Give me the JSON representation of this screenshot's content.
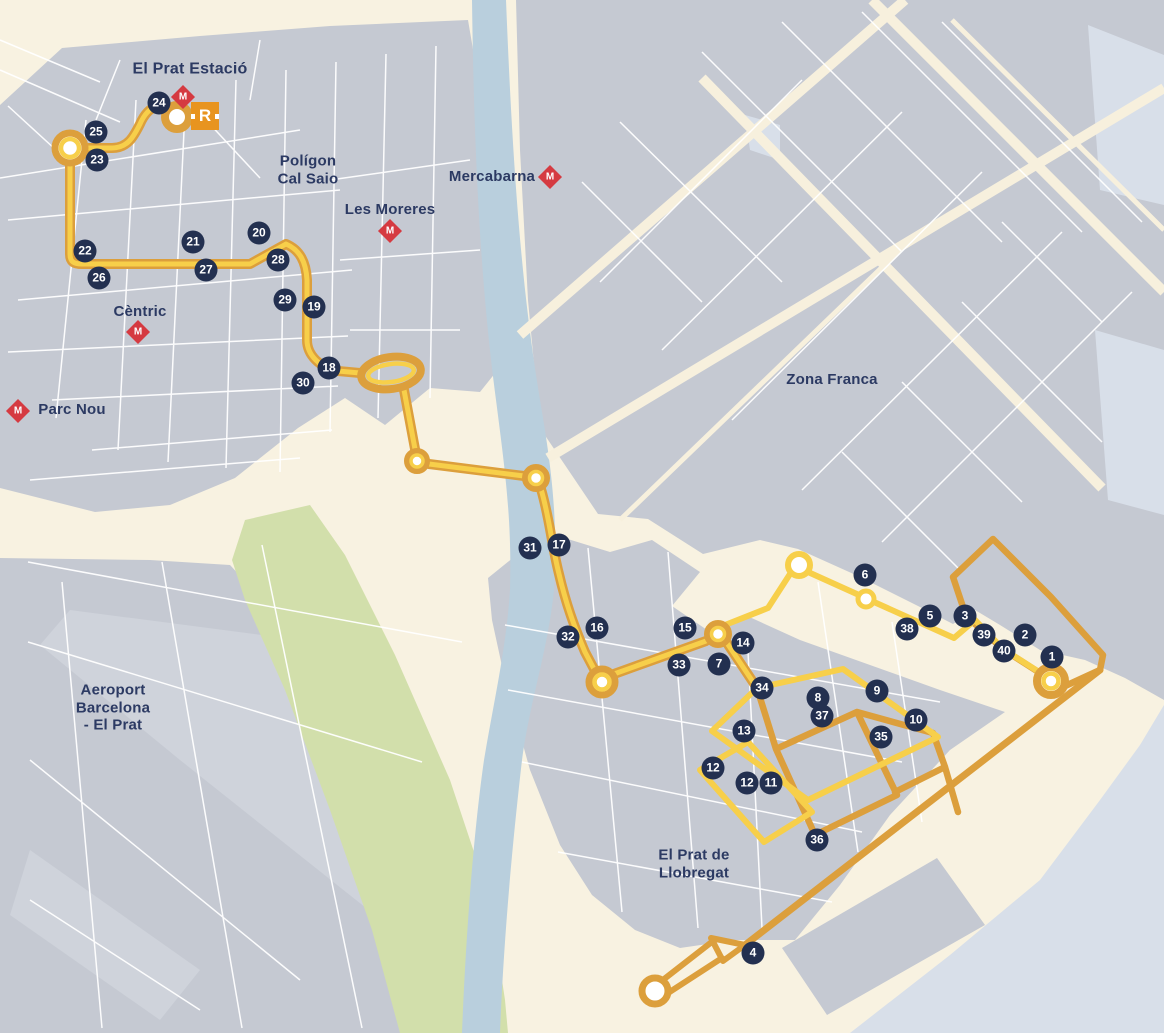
{
  "map": {
    "colors": {
      "background": "#f8f2e1",
      "urban": "#c5c9d2",
      "urban_light": "#cfd3db",
      "water_river": "#b9cfdd",
      "water_sea": "#d8dfe9",
      "park": "#d2dfab",
      "street": "#ffffff",
      "road_beige": "#f7f0dd",
      "route_yellow": "#f7cf4a",
      "route_orange": "#dc9f3c",
      "stop_badge_bg": "#233050",
      "stop_badge_text": "#ffffff",
      "label_text": "#2c3a63",
      "metro_red": "#d53a41",
      "rodalies_orange": "#e8941f"
    },
    "places": [
      {
        "id": "el-prat-estacio",
        "lines": [
          "El Prat Estació"
        ],
        "x": 190,
        "y": 70,
        "size": 16
      },
      {
        "id": "poligon-cal-saio",
        "lines": [
          "Polígon",
          "Cal Saio"
        ],
        "x": 308,
        "y": 170,
        "size": 15
      },
      {
        "id": "les-moreres",
        "lines": [
          "Les Moreres"
        ],
        "x": 390,
        "y": 210,
        "size": 15
      },
      {
        "id": "mercabarna",
        "lines": [
          "Mercabarna"
        ],
        "x": 492,
        "y": 177,
        "size": 15
      },
      {
        "id": "zona-franca",
        "lines": [
          "Zona Franca"
        ],
        "x": 832,
        "y": 380,
        "size": 15
      },
      {
        "id": "centric",
        "lines": [
          "Cèntric"
        ],
        "x": 140,
        "y": 312,
        "size": 15
      },
      {
        "id": "parc-nou",
        "lines": [
          "Parc Nou"
        ],
        "x": 72,
        "y": 410,
        "size": 15
      },
      {
        "id": "aeroport-barcelona-el-prat",
        "lines": [
          "Aeroport",
          "Barcelona",
          "- El Prat"
        ],
        "x": 113,
        "y": 708,
        "size": 15
      },
      {
        "id": "el-prat-de-llobregat",
        "lines": [
          "El Prat de",
          "Llobregat"
        ],
        "x": 694,
        "y": 864,
        "size": 15
      }
    ],
    "metro_m_label": "M",
    "metro_stations": [
      {
        "station": "el-prat-estacio",
        "x": 183,
        "y": 97
      },
      {
        "station": "les-moreres",
        "x": 390,
        "y": 231
      },
      {
        "station": "mercabarna",
        "x": 550,
        "y": 177
      },
      {
        "station": "centric",
        "x": 138,
        "y": 332
      },
      {
        "station": "parc-nou",
        "x": 18,
        "y": 411
      }
    ],
    "rodalies_station": {
      "label": "R",
      "x": 205,
      "y": 116
    },
    "stops": [
      {
        "num": "1",
        "x": 1052,
        "y": 657
      },
      {
        "num": "2",
        "x": 1025,
        "y": 635
      },
      {
        "num": "3",
        "x": 965,
        "y": 616
      },
      {
        "num": "4",
        "x": 753,
        "y": 953
      },
      {
        "num": "5",
        "x": 930,
        "y": 616
      },
      {
        "num": "6",
        "x": 865,
        "y": 575
      },
      {
        "num": "7",
        "x": 719,
        "y": 664
      },
      {
        "num": "8",
        "x": 818,
        "y": 698
      },
      {
        "num": "9",
        "x": 877,
        "y": 691
      },
      {
        "num": "10",
        "x": 916,
        "y": 720
      },
      {
        "num": "11",
        "x": 771,
        "y": 783
      },
      {
        "num": "12",
        "x": 713,
        "y": 768
      },
      {
        "num": "12",
        "x": 747,
        "y": 783
      },
      {
        "num": "13",
        "x": 744,
        "y": 731
      },
      {
        "num": "14",
        "x": 743,
        "y": 643
      },
      {
        "num": "15",
        "x": 685,
        "y": 628
      },
      {
        "num": "16",
        "x": 597,
        "y": 628
      },
      {
        "num": "17",
        "x": 559,
        "y": 545
      },
      {
        "num": "18",
        "x": 329,
        "y": 368
      },
      {
        "num": "19",
        "x": 314,
        "y": 307
      },
      {
        "num": "20",
        "x": 259,
        "y": 233
      },
      {
        "num": "21",
        "x": 193,
        "y": 242
      },
      {
        "num": "22",
        "x": 85,
        "y": 251
      },
      {
        "num": "23",
        "x": 97,
        "y": 160
      },
      {
        "num": "24",
        "x": 159,
        "y": 103
      },
      {
        "num": "25",
        "x": 96,
        "y": 132
      },
      {
        "num": "26",
        "x": 99,
        "y": 278
      },
      {
        "num": "27",
        "x": 206,
        "y": 270
      },
      {
        "num": "28",
        "x": 278,
        "y": 260
      },
      {
        "num": "29",
        "x": 285,
        "y": 300
      },
      {
        "num": "30",
        "x": 303,
        "y": 383
      },
      {
        "num": "31",
        "x": 530,
        "y": 548
      },
      {
        "num": "32",
        "x": 568,
        "y": 637
      },
      {
        "num": "33",
        "x": 679,
        "y": 665
      },
      {
        "num": "34",
        "x": 762,
        "y": 688
      },
      {
        "num": "35",
        "x": 881,
        "y": 737
      },
      {
        "num": "36",
        "x": 817,
        "y": 840
      },
      {
        "num": "37",
        "x": 822,
        "y": 716
      },
      {
        "num": "38",
        "x": 907,
        "y": 629
      },
      {
        "num": "39",
        "x": 984,
        "y": 635
      },
      {
        "num": "40",
        "x": 1004,
        "y": 651
      }
    ]
  }
}
